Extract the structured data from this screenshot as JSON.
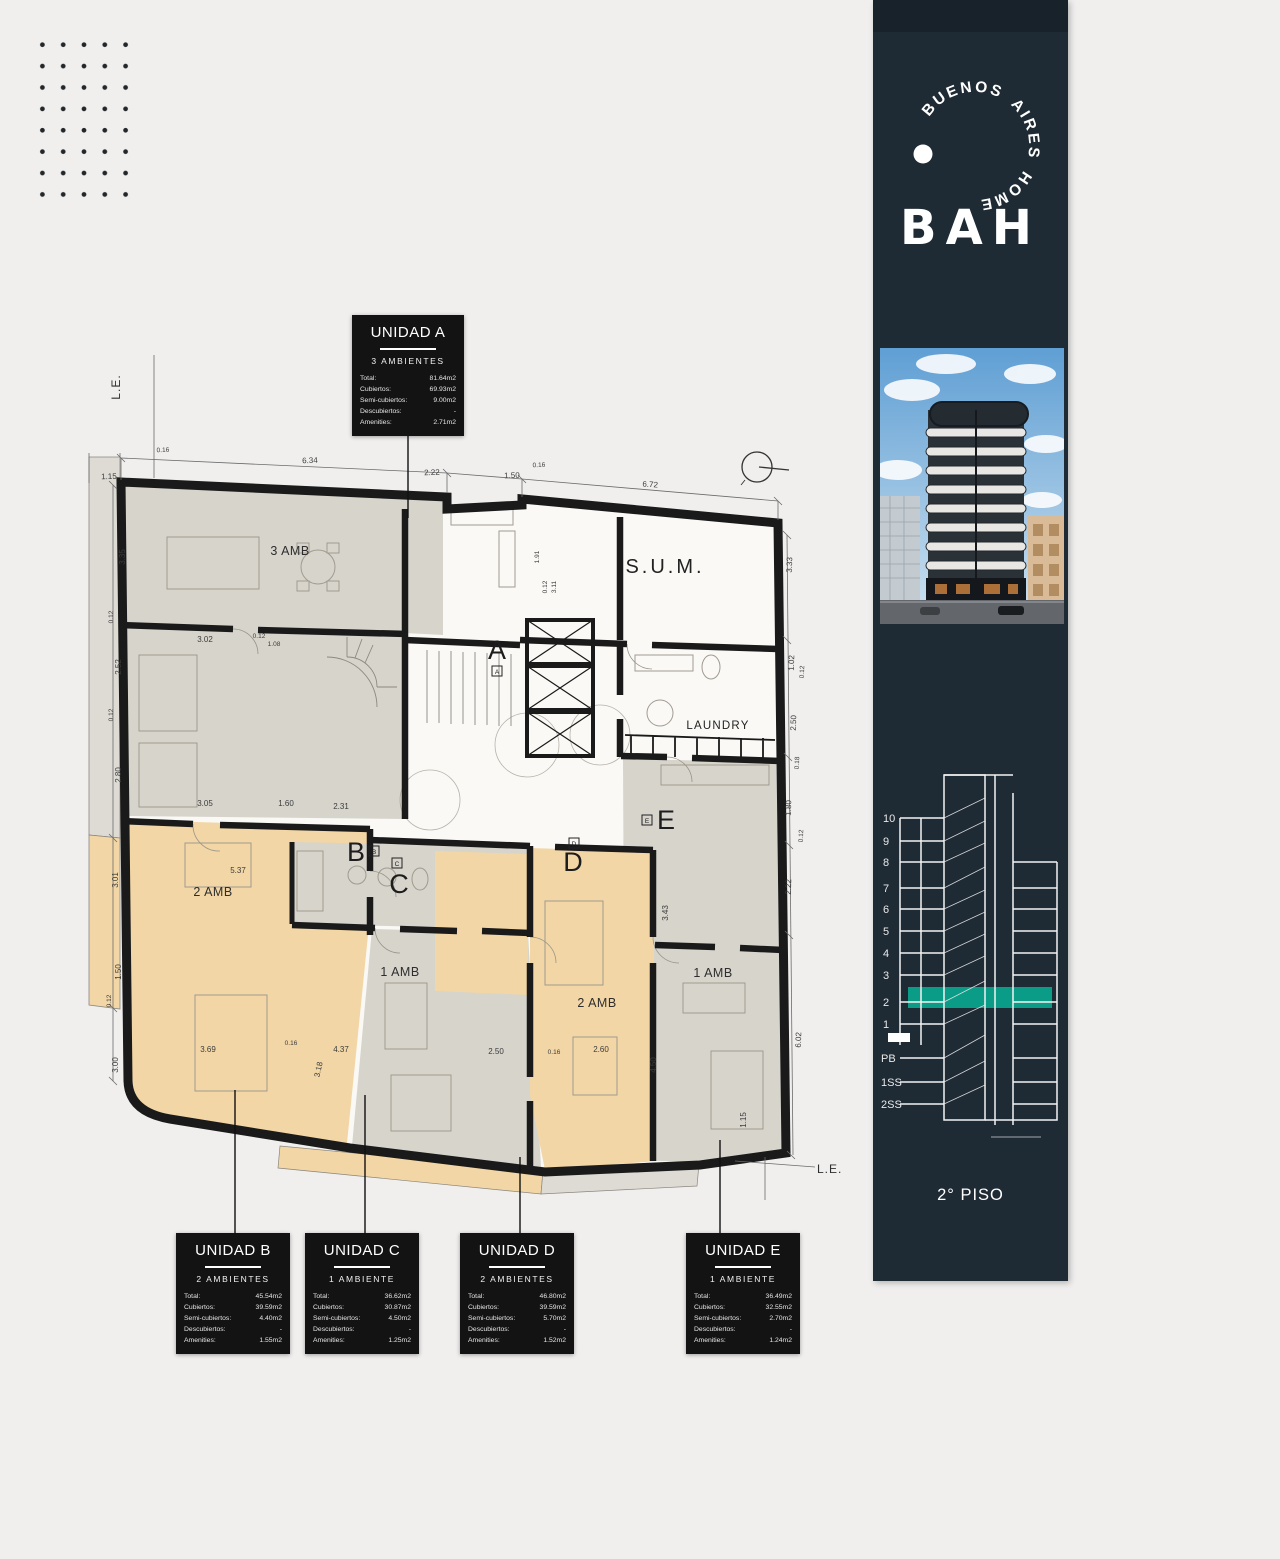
{
  "branding": {
    "circle_text": "BUENOS AIRES HOME",
    "wordmark": "BAH",
    "floor_caption": "2° PISO"
  },
  "section_diagram": {
    "floors": [
      "10",
      "9",
      "8",
      "7",
      "6",
      "5",
      "4",
      "3",
      "2",
      "1",
      "PB",
      "1SS",
      "2SS"
    ],
    "highlight_floor": "2",
    "highlight_color": "#0a9c86"
  },
  "plan": {
    "room_labels": {
      "unit_a": "3 AMB",
      "sum": "S.U.M.",
      "laundry": "LAUNDRY",
      "unit_b": "2 AMB",
      "unit_c": "1 AMB",
      "unit_d": "2 AMB",
      "unit_e": "1 AMB"
    },
    "unit_letters": {
      "a": "A",
      "b": "B",
      "c": "C",
      "d": "D",
      "e": "E"
    },
    "le_labels": {
      "top": "L.E.",
      "bottom": "L.E."
    },
    "dimensions": {
      "top": [
        "0.16",
        "6.34",
        "2.22",
        "1.50",
        "0.16",
        "6.72",
        "1.15"
      ],
      "left": [
        "3.35",
        "0.12",
        "2.52",
        "0.12",
        "2.80",
        "3.01",
        "1.50",
        "0.12",
        "3.00"
      ],
      "right": [
        "3.33",
        "1.02",
        "0.12",
        "2.50",
        "0.18",
        "1.80",
        "0.12",
        "2.22",
        "6.02",
        "1.15"
      ],
      "inner": [
        "3.02",
        "0.12",
        "1.08",
        "1.91",
        "0.12",
        "3.11",
        "3.05",
        "1.60",
        "2.31",
        "5.37",
        "3.43",
        "3.69",
        "0.16",
        "3.18",
        "4.37",
        "2.50",
        "0.16",
        "2.60",
        "4.50"
      ]
    }
  },
  "units": [
    {
      "id": "a",
      "title": "UNIDAD A",
      "subtitle": "3 AMBIENTES",
      "rows": [
        {
          "label": "Total:",
          "value": "81.64m2"
        },
        {
          "label": "Cubiertos:",
          "value": "69.93m2"
        },
        {
          "label": "Semi-cubiertos:",
          "value": "9.00m2"
        },
        {
          "label": "Descubiertos:",
          "value": "-"
        },
        {
          "label": "Amenities:",
          "value": "2.71m2"
        }
      ]
    },
    {
      "id": "b",
      "title": "UNIDAD B",
      "subtitle": "2 AMBIENTES",
      "rows": [
        {
          "label": "Total:",
          "value": "45.54m2"
        },
        {
          "label": "Cubiertos:",
          "value": "39.59m2"
        },
        {
          "label": "Semi-cubiertos:",
          "value": "4.40m2"
        },
        {
          "label": "Descubiertos:",
          "value": "-"
        },
        {
          "label": "Amenities:",
          "value": "1.55m2"
        }
      ]
    },
    {
      "id": "c",
      "title": "UNIDAD C",
      "subtitle": "1 AMBIENTE",
      "rows": [
        {
          "label": "Total:",
          "value": "36.62m2"
        },
        {
          "label": "Cubiertos:",
          "value": "30.87m2"
        },
        {
          "label": "Semi-cubiertos:",
          "value": "4.50m2"
        },
        {
          "label": "Descubiertos:",
          "value": "-"
        },
        {
          "label": "Amenities:",
          "value": "1.25m2"
        }
      ]
    },
    {
      "id": "d",
      "title": "UNIDAD D",
      "subtitle": "2 AMBIENTES",
      "rows": [
        {
          "label": "Total:",
          "value": "46.80m2"
        },
        {
          "label": "Cubiertos:",
          "value": "39.59m2"
        },
        {
          "label": "Semi-cubiertos:",
          "value": "5.70m2"
        },
        {
          "label": "Descubiertos:",
          "value": "-"
        },
        {
          "label": "Amenities:",
          "value": "1.52m2"
        }
      ]
    },
    {
      "id": "e",
      "title": "UNIDAD E",
      "subtitle": "1 AMBIENTE",
      "rows": [
        {
          "label": "Total:",
          "value": "36.49m2"
        },
        {
          "label": "Cubiertos:",
          "value": "32.55m2"
        },
        {
          "label": "Semi-cubiertos:",
          "value": "2.70m2"
        },
        {
          "label": "Descubiertos:",
          "value": "-"
        },
        {
          "label": "Amenities:",
          "value": "1.24m2"
        }
      ]
    }
  ]
}
